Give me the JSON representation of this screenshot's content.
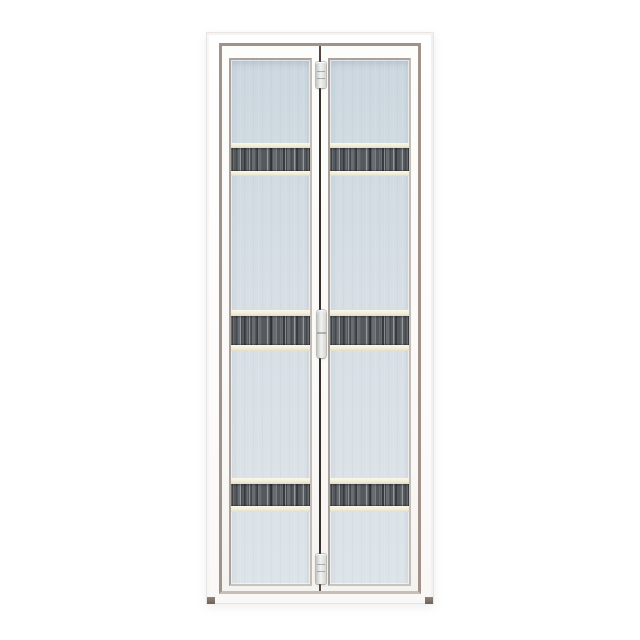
{
  "scene": {
    "type": "product-photo",
    "subject": "White aluminium bi-fold door with two folding leaves, frosted light-blue glass panels and three dark wood-grain accent strips",
    "background": "#ffffff"
  },
  "door": {
    "parts": {
      "frame": "outer white aluminium door frame",
      "trim": "taupe inner frame trim",
      "leaves": [
        "left folding leaf",
        "right folding leaf"
      ],
      "glass": "frosted pale blue-grey glass panel per leaf",
      "accent_strips": [
        "upper wood-grain strip",
        "middle wood-grain strip",
        "lower wood-grain strip"
      ],
      "hardware": [
        "top pivot hinge",
        "centre pull handle",
        "bottom pivot hinge"
      ],
      "feet": [
        "left frame foot",
        "right frame foot"
      ]
    },
    "colors": {
      "background": "#ffffff",
      "frame_white": "#fdfcfb",
      "frame_edge": "#e8e5e2",
      "trim_taupe": "#a2938a",
      "glass_top": "#ccd7df",
      "glass_mid": "#d7dfe5",
      "glass_bottom": "#dde4e9",
      "strip_dark": "#54595e",
      "strip_band_cream": "#f2edda",
      "seam_dark": "#382f29",
      "hardware_light": "#f2f3f0",
      "foot_dark": "#6e635b"
    }
  }
}
